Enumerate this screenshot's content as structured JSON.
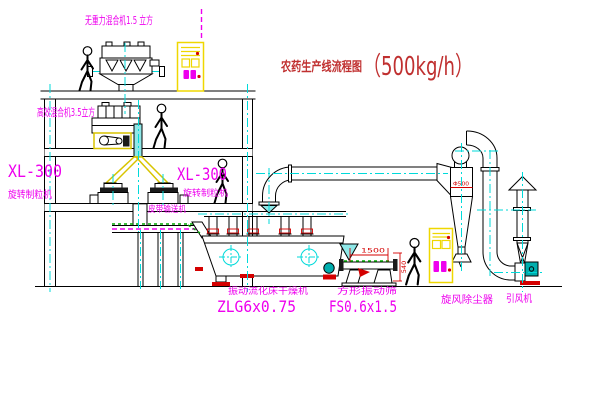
{
  "title": {
    "text": "农药生产线流程图",
    "capacity": "（500kg/h）"
  },
  "labels": {
    "gravity_mixer": "无重力混合机1.5 立方",
    "mixer_2f": "高效混合机3.5立方",
    "granulator_left_model": "XL-300",
    "granulator_left_name": "旋转制粒机",
    "granulator_mid_model": "XL-300",
    "granulator_mid_name": "旋转制粒机",
    "belt_conveyor": "皮带输送机",
    "dryer_name": "振动流化床干燥机",
    "dryer_model": "ZLG6x0.75",
    "sieve_name": "方形振动筛",
    "sieve_model": "FS0.6x1.5",
    "cyclone_name": "旋风除尘器",
    "fan_name": "引风机"
  },
  "dimensions": {
    "cyclone_diameter": "Φ500",
    "sieve_length": "1500",
    "sieve_height": "540"
  },
  "colors": {
    "label_magenta": "#EE00EE",
    "title_red": "#C03030",
    "centerline_cyan": "#00DADA",
    "highlight_yellow": "#EFD700",
    "dimension_red": "#D40000",
    "machine_teal": "#00AEAE",
    "green_mark": "#00A800"
  }
}
